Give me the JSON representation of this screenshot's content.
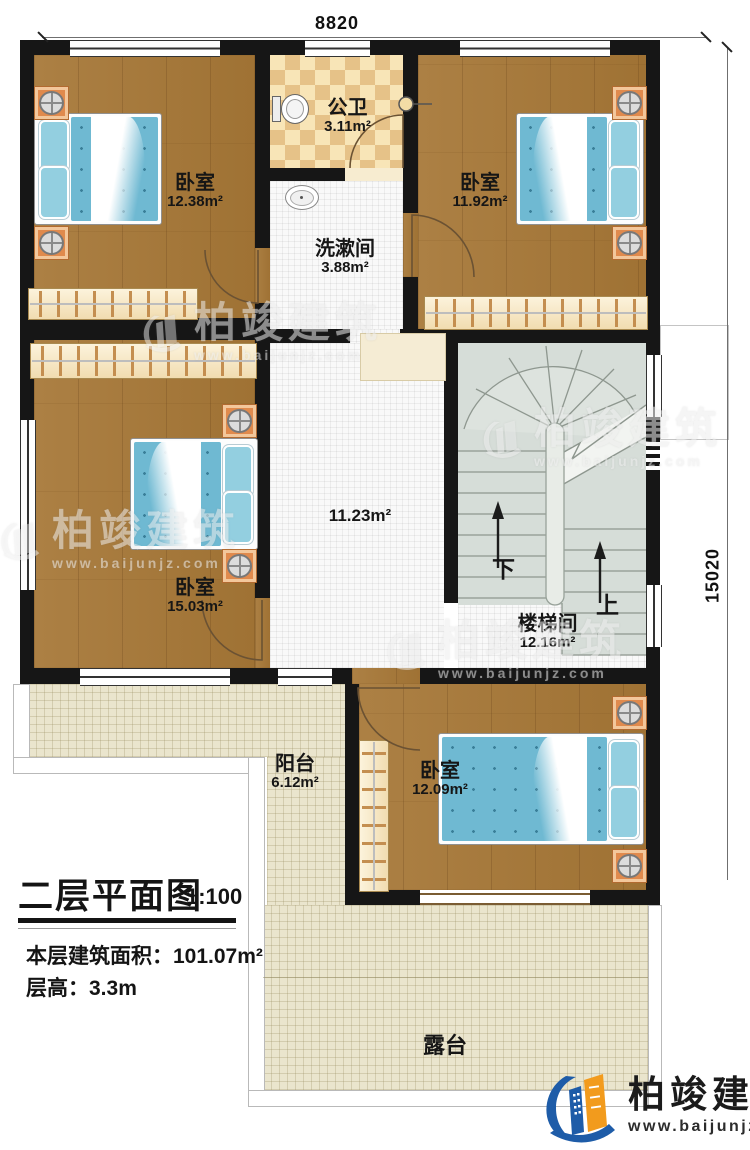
{
  "plan": {
    "dimensions": {
      "top": "8820",
      "right": "15020"
    },
    "rooms": [
      {
        "id": "bedroom-top-left",
        "name": "卧室",
        "area": "12.38m²"
      },
      {
        "id": "public-bathroom",
        "name": "公卫",
        "area": "3.11m²"
      },
      {
        "id": "washroom",
        "name": "洗漱间",
        "area": "3.88m²"
      },
      {
        "id": "bedroom-top-right",
        "name": "卧室",
        "area": "11.92m²"
      },
      {
        "id": "bedroom-mid-left",
        "name": "卧室",
        "area": "15.03m²"
      },
      {
        "id": "hallway",
        "name": "",
        "area": "11.23m²"
      },
      {
        "id": "stairwell",
        "name": "楼梯间",
        "area": "12.16m²"
      },
      {
        "id": "bedroom-bottom",
        "name": "卧室",
        "area": "12.09m²"
      },
      {
        "id": "balcony",
        "name": "阳台",
        "area": "6.12m²"
      },
      {
        "id": "terrace",
        "name": "露台",
        "area": ""
      }
    ],
    "stairs": {
      "down_label": "下",
      "up_label": "上"
    }
  },
  "title_block": {
    "title": "二层平面图",
    "scale": "1:100",
    "area_line": "本层建筑面积：101.07m²",
    "height_line": "层高：3.3m"
  },
  "brand": {
    "name": "柏竣建筑",
    "url": "www.baijunjz.com"
  },
  "watermark": {
    "name": "柏竣建筑",
    "url": "www.baijunjz.com"
  }
}
